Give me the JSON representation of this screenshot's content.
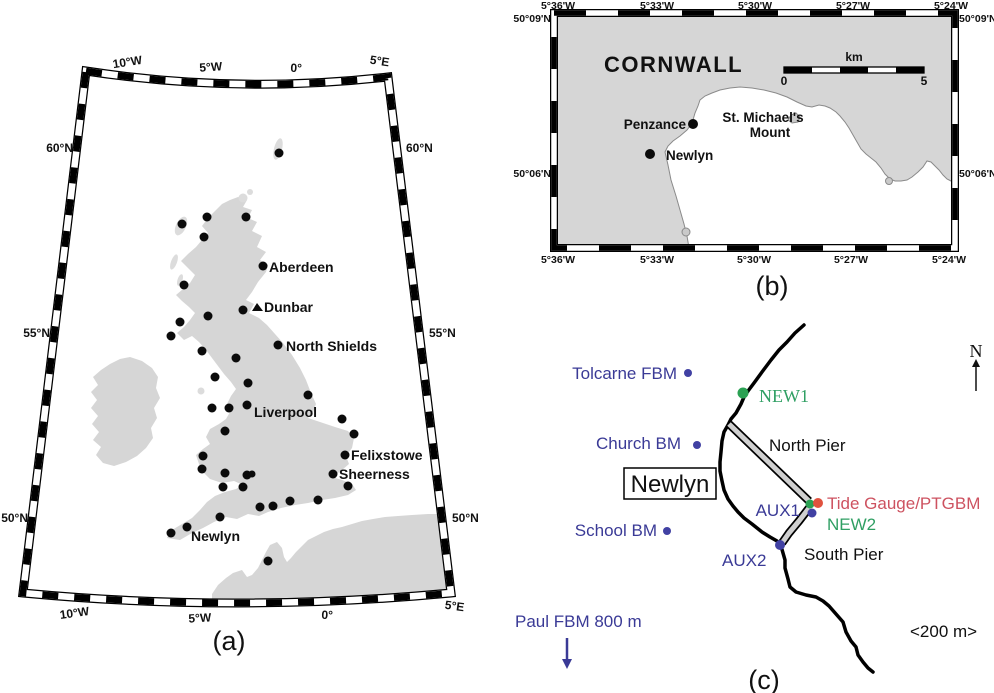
{
  "captions": {
    "a": "(a)",
    "b": "(b)",
    "c": "(c)"
  },
  "panel_a": {
    "lon_top": [
      "10°W",
      "5°W",
      "0°",
      "5°E"
    ],
    "lon_bottom": [
      "10°W",
      "5°W",
      "0°",
      "5°E"
    ],
    "lat_left": [
      "60°N",
      "55°N",
      "50°N"
    ],
    "lat_right": [
      "60°N",
      "55°N",
      "50°N"
    ],
    "stations": {
      "aberdeen": "Aberdeen",
      "dunbar": "Dunbar",
      "north_shields": "North Shields",
      "liverpool": "Liverpool",
      "felixstowe": "Felixstowe",
      "sheerness": "Sheerness",
      "newlyn": "Newlyn"
    }
  },
  "panel_b": {
    "region": "CORNWALL",
    "lon_top": [
      "5°36'W",
      "5°33'W",
      "5°30'W",
      "5°27'W",
      "5°24'W"
    ],
    "lon_bottom": [
      "5°36'W",
      "5°33'W",
      "5°30'W",
      "5°27'W",
      "5°24'W"
    ],
    "lat_left": [
      "50°09'N",
      "50°06'N"
    ],
    "lat_right": [
      "50°09'N",
      "50°06'N"
    ],
    "scalebar": {
      "unit": "km",
      "start": "0",
      "end": "5"
    },
    "places": {
      "penzance": "Penzance",
      "st_michaels_line1": "St. Michael's",
      "st_michaels_line2": "Mount",
      "newlyn": "Newlyn"
    }
  },
  "panel_c": {
    "north_label": "N",
    "town_box": "Newlyn",
    "benchmarks": {
      "tolcarne": "Tolcarne FBM",
      "church": "Church BM",
      "school": "School BM",
      "paul": "Paul FBM 800 m",
      "aux1": "AUX1",
      "aux2": "AUX2"
    },
    "gnss": {
      "new1": "NEW1",
      "new2": "NEW2"
    },
    "tide_gauge": "Tide Gauge/PTGBM",
    "piers": {
      "north": "North Pier",
      "south": "South Pier"
    },
    "scale_note": "<200 m>"
  },
  "colors": {
    "land": "#d6d6d6",
    "benchmark_blue": "#3a3a96",
    "gnss_green": "#2f9f63",
    "tide_gauge_red": "#cd5260",
    "dot_black": "#0b0b0b"
  }
}
